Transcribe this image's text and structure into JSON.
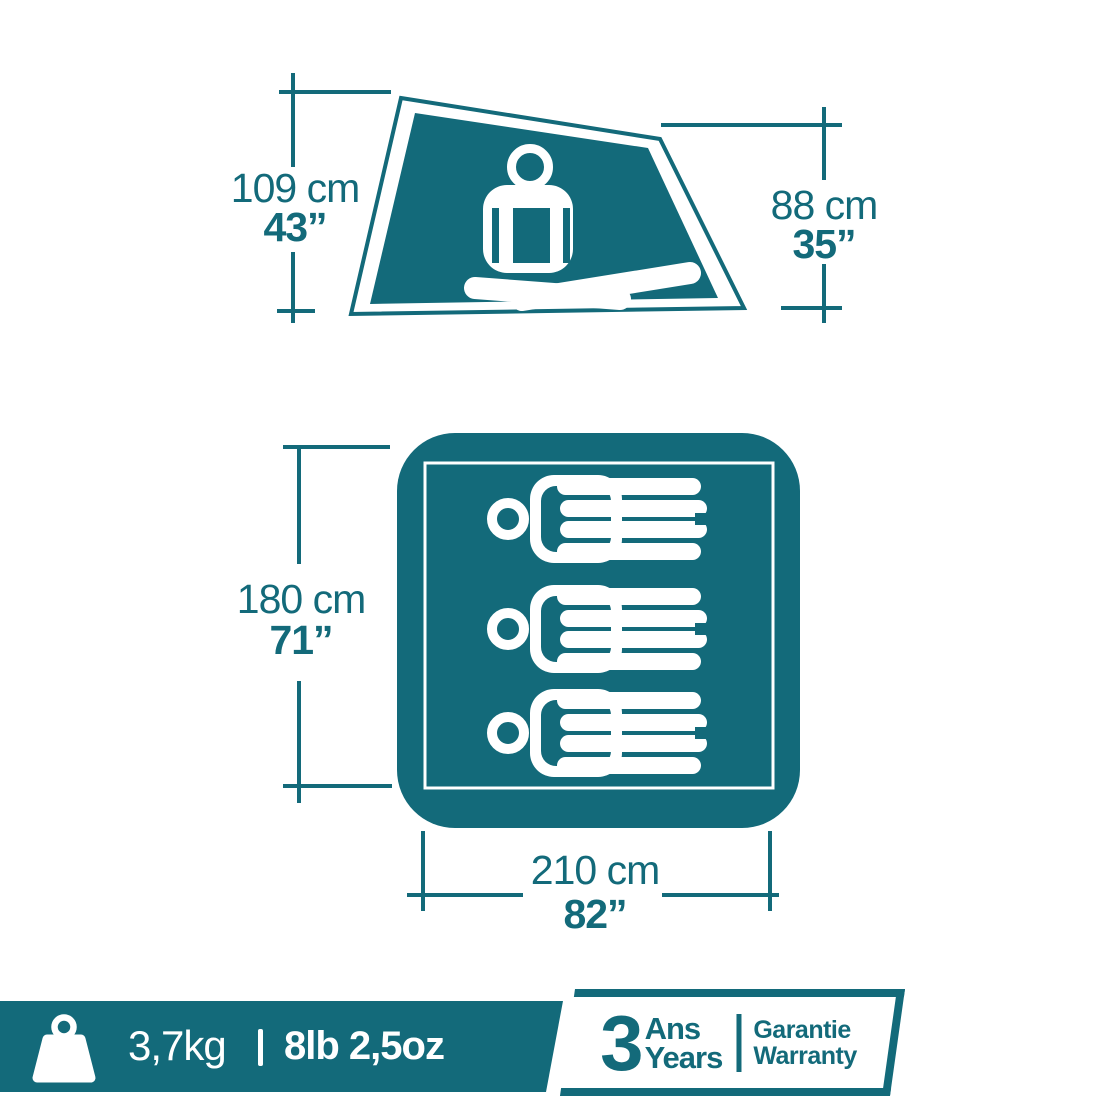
{
  "diagram": {
    "side_view": {
      "height_left_metric": "109 cm",
      "height_left_imperial": "43”",
      "height_right_metric": "88 cm",
      "height_right_imperial": "35”"
    },
    "floor_view": {
      "depth_metric": "180 cm",
      "depth_imperial": "71”",
      "width_metric": "210 cm",
      "width_imperial": "82”",
      "sleeping_capacity": "3"
    },
    "footer": {
      "weight_metric": "3,7kg",
      "weight_imperial": "8lb 2,5oz",
      "warranty_years": "3",
      "warranty_unit_fr": "Ans",
      "warranty_unit_en": "Years",
      "warranty_word_fr": "Garantie",
      "warranty_word_en": "Warranty"
    },
    "colors": {
      "teal": "#136a7a",
      "white": "#ffffff"
    }
  }
}
